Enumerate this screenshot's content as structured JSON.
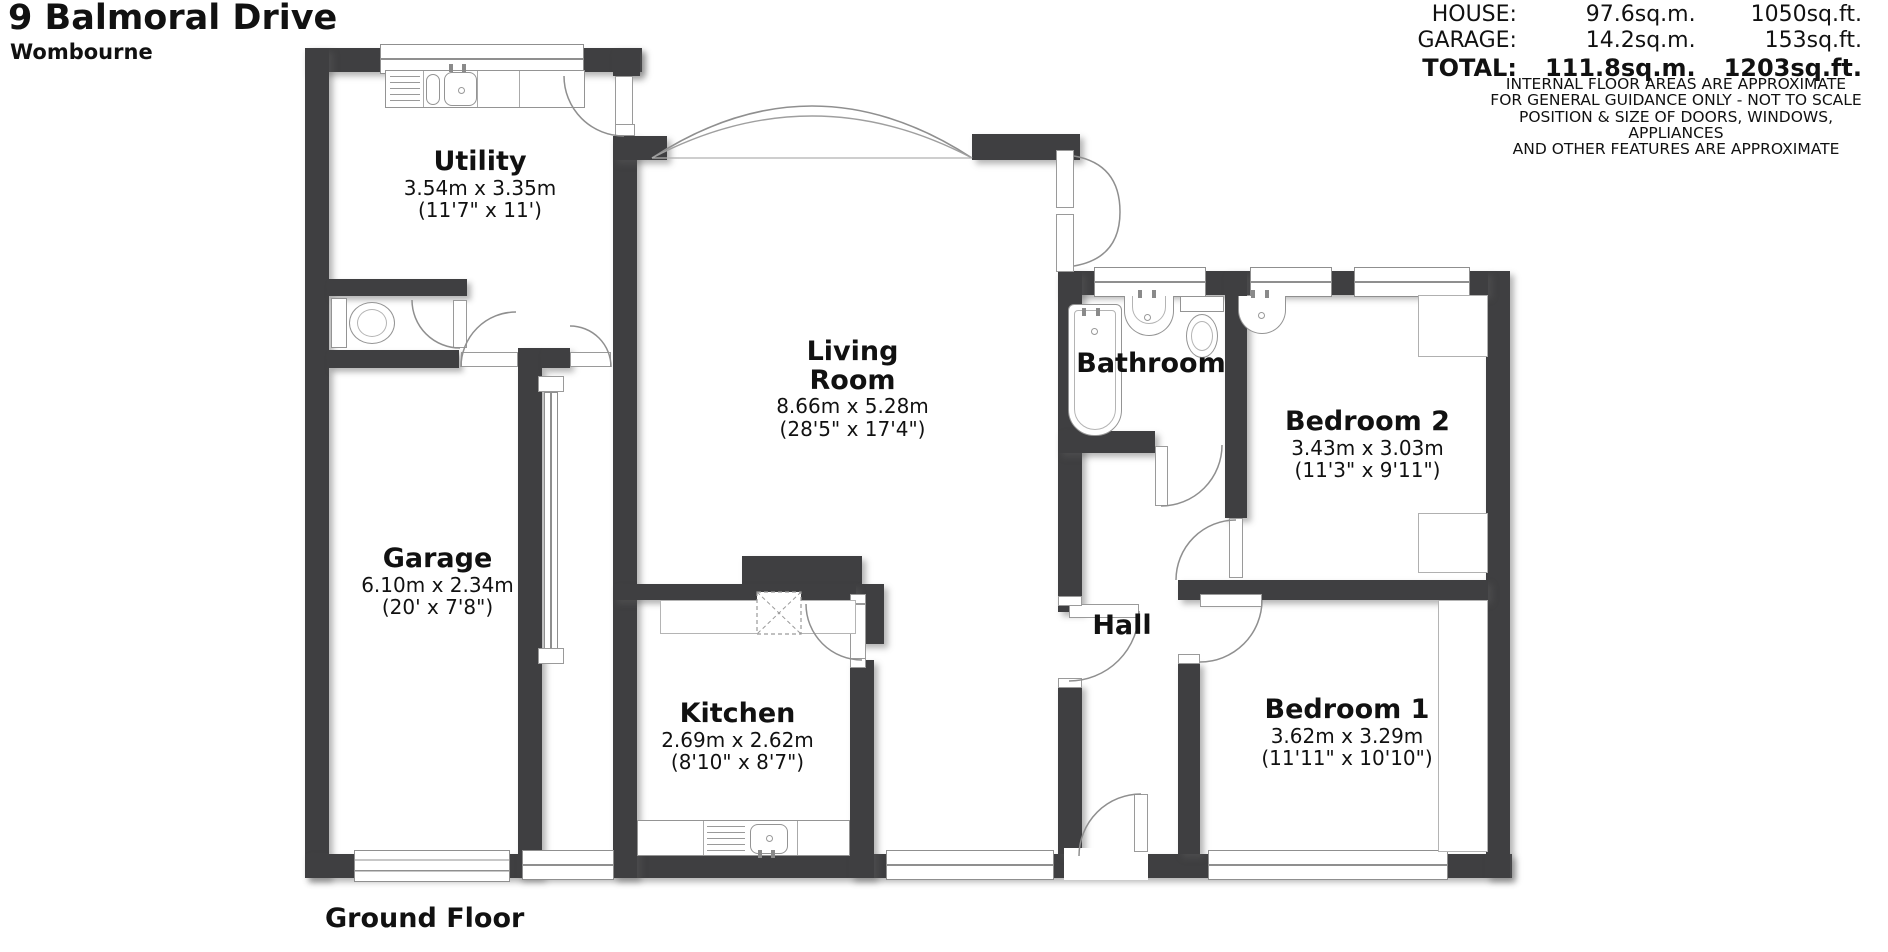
{
  "header": {
    "title": "9 Balmoral Drive",
    "subtitle": "Wombourne",
    "floor_label": "Ground Floor"
  },
  "areas": {
    "rows": [
      {
        "label": "HOUSE:",
        "sqm": "97.6sq.m.",
        "sqft": "1050sq.ft."
      },
      {
        "label": "GARAGE:",
        "sqm": "14.2sq.m.",
        "sqft": "153sq.ft."
      },
      {
        "label": "TOTAL:",
        "sqm": "111.8sq.m.",
        "sqft": "1203sq.ft."
      }
    ],
    "disclaimer": [
      "INTERNAL FLOOR AREAS ARE APPROXIMATE",
      "FOR GENERAL GUIDANCE ONLY - NOT TO SCALE",
      "POSITION & SIZE OF DOORS, WINDOWS, APPLIANCES",
      "AND OTHER FEATURES ARE APPROXIMATE"
    ]
  },
  "rooms": [
    {
      "name": "Utility",
      "metric": "3.54m x 3.35m",
      "imperial": "(11'7\" x 11')"
    },
    {
      "name": "Garage",
      "metric": "6.10m x 2.34m",
      "imperial": "(20' x 7'8\")"
    },
    {
      "name": "Living Room",
      "metric": "8.66m x 5.28m",
      "imperial": "(28'5\" x 17'4\")"
    },
    {
      "name": "Kitchen",
      "metric": "2.69m x 2.62m",
      "imperial": "(8'10\" x 8'7\")"
    },
    {
      "name": "Bathroom"
    },
    {
      "name": "Bedroom 2",
      "metric": "3.43m x 3.03m",
      "imperial": "(11'3\" x 9'11\")"
    },
    {
      "name": "Hall"
    },
    {
      "name": "Bedroom 1",
      "metric": "3.62m x 3.29m",
      "imperial": "(11'11\" x 10'10\")"
    }
  ],
  "colors": {
    "wall": "#3f3f41",
    "line": "#8f8f8f"
  }
}
